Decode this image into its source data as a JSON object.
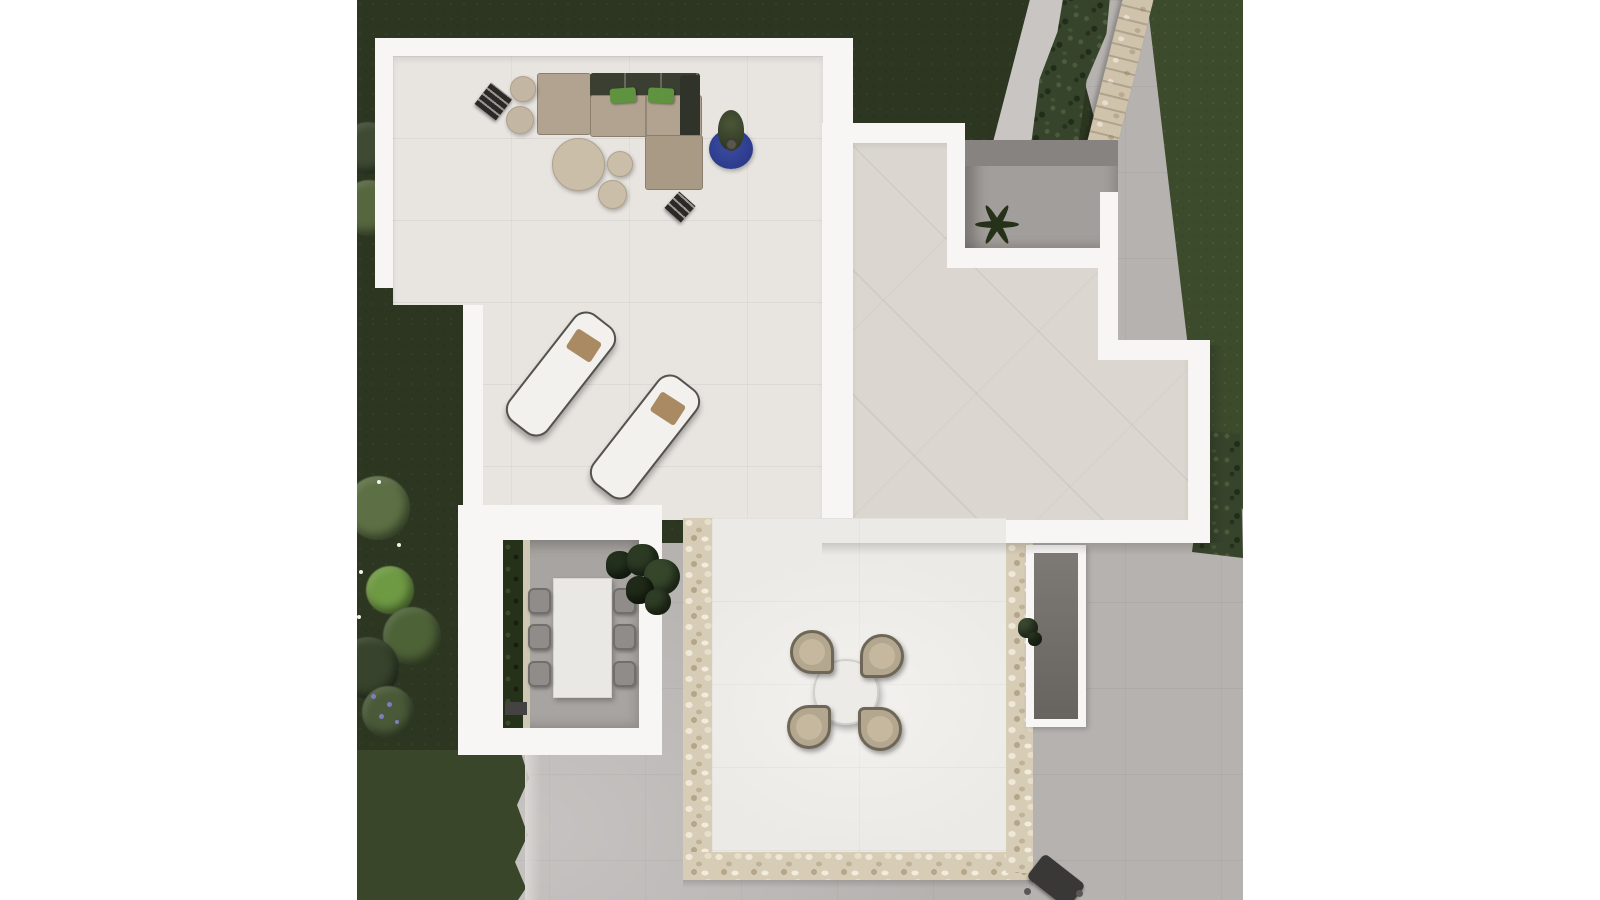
{
  "scene": {
    "type": "aerial-architectural-render",
    "description": "Top-down 3D render of a modern white villa with roof terraces, garden lawn, hedge and stone wall"
  },
  "palette": {
    "grass": "#2c3621",
    "grassLight": "#3a4629",
    "grassCorner": "#3d4b2d",
    "pavement": "#b6b2b0",
    "pavementLight": "#c9c5c2",
    "white": "#f7f6f4",
    "floorWarm": "#e8e5e1",
    "floorCream": "#dbd7d0",
    "floorBright": "#eceae6",
    "pebble": "#d7cdb7",
    "hedge": "#37442c",
    "wallStone": "#cfc3ac",
    "sofa": "#b2a390",
    "sofaDark": "#3a3f31",
    "pillowGreen": "#5f9340",
    "rugBlue": "#2c3b8b",
    "pouf": "#c3b6a2",
    "tableBeige": "#cbbea9",
    "chairGray": "#8f8c89",
    "chairBeige": "#b4a78f",
    "chairTrim": "#6e6757",
    "plantDark": "#263119",
    "courtyard": "#a29e9b",
    "planterIn": "#75716d",
    "doorDark": "#454341",
    "loungerPillow": "#aa8a63",
    "frameDark": "#55524d"
  },
  "objects": {
    "lawn": {
      "label": "garden lawn"
    },
    "lawnCorner": {
      "label": "lawn beyond boundary wall"
    },
    "pavement": {
      "label": "gray paved surround"
    },
    "pathBand": {
      "label": "diagonal paved path"
    },
    "hedge": {
      "label": "hedge along boundary"
    },
    "wall": {
      "label": "natural stone boundary wall"
    },
    "terraceLounge": {
      "label": "roof terrace with lounge set"
    },
    "terraceTiled": {
      "label": "roof terrace with diagonal tiles"
    },
    "innerCourtyard": {
      "label": "sunken inner courtyard with palm"
    },
    "diningCourtyard": {
      "label": "dining courtyard"
    },
    "centralPatio": {
      "label": "patio terrace with pebble border"
    },
    "sofa": {
      "label": "L-shaped lounge sofa with green pillows"
    },
    "loungers": {
      "label": "two sun loungers"
    },
    "rug": {
      "label": "round blue rug with potted plant"
    },
    "coffeeTables": {
      "label": "round coffee tables and poufs"
    },
    "diningTable": {
      "label": "dining table with six chairs"
    },
    "roundTable": {
      "label": "round table with four chairs"
    },
    "planter": {
      "label": "planter trough"
    },
    "grill": {
      "label": "barbecue at lower edge"
    },
    "bushes": {
      "label": "garden shrubs and flowers"
    }
  }
}
